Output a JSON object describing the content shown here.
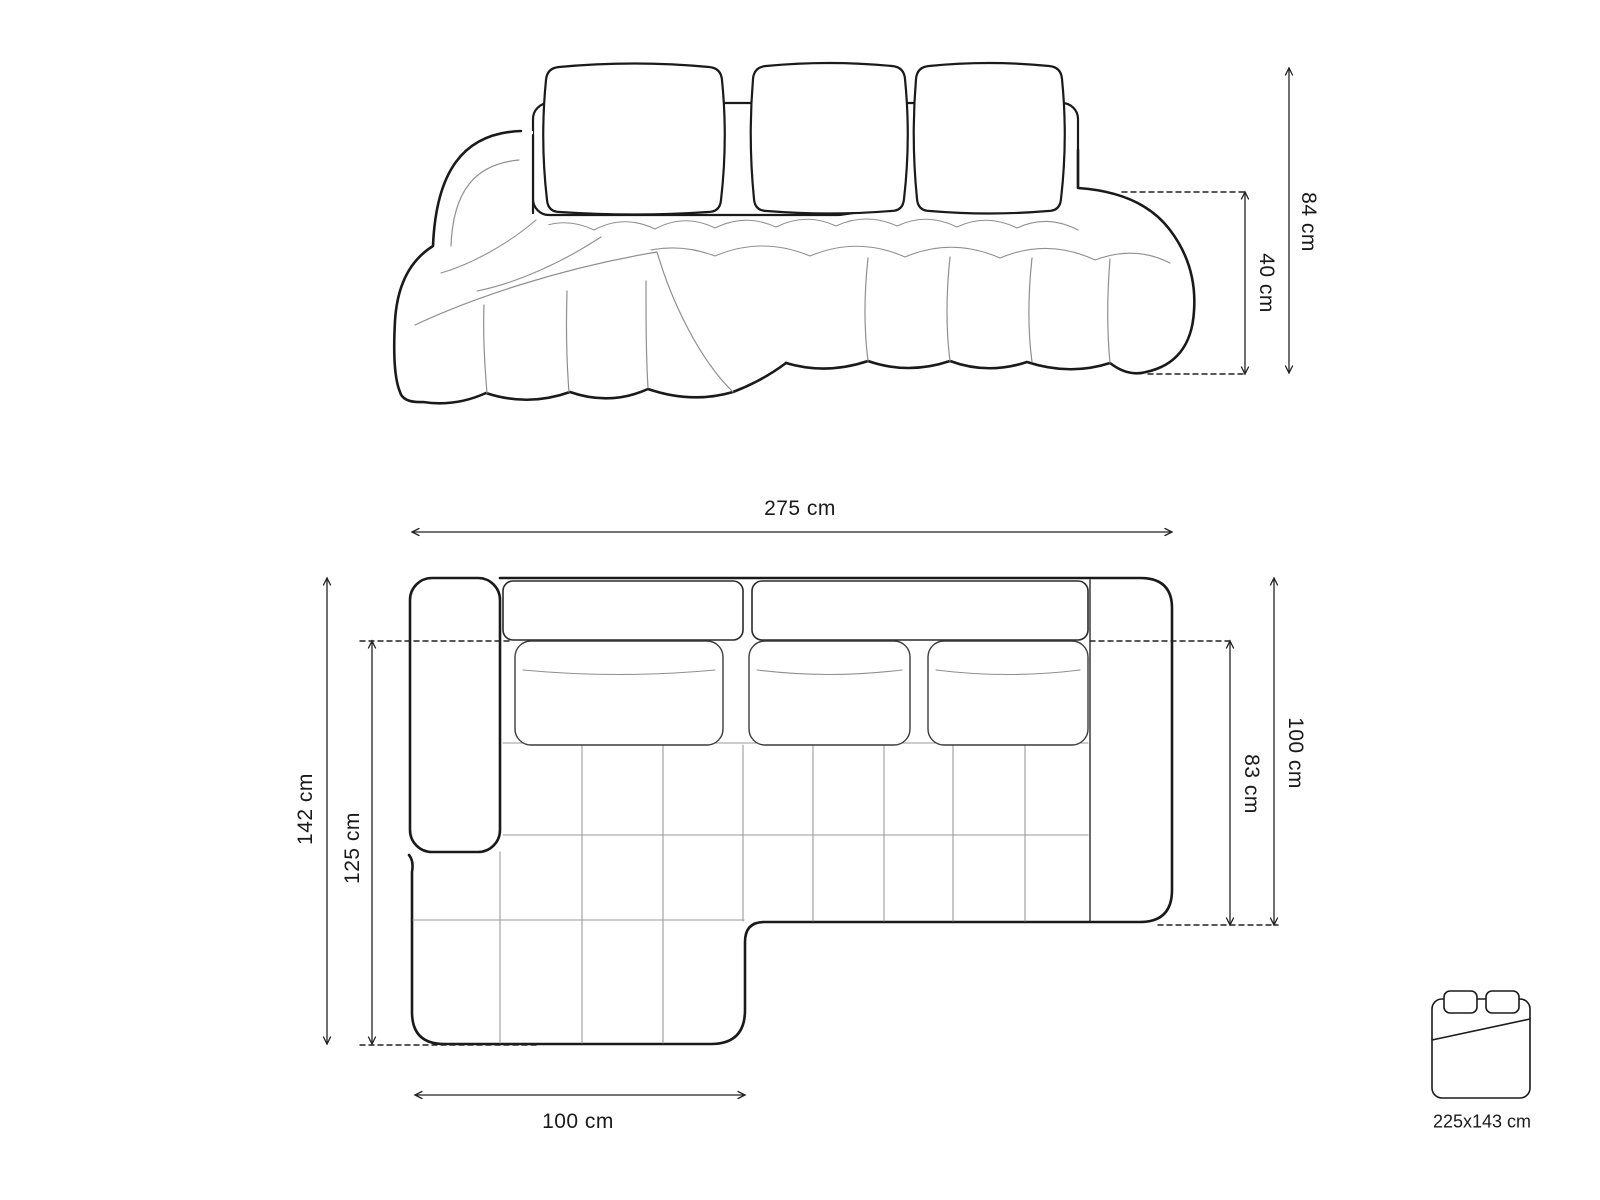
{
  "page": {
    "background": "#ffffff"
  },
  "front_view": {
    "name": "sofa front elevation",
    "dimensions": {
      "total_height": "84 cm",
      "seat_height": "40 cm"
    }
  },
  "top_view": {
    "name": "sofa top plan",
    "dimensions": {
      "total_width": "275 cm",
      "total_depth": "142 cm",
      "chaise_length": "125 cm",
      "right_side_depth": "100 cm",
      "right_seat_depth": "83 cm",
      "chaise_width": "100 cm"
    }
  },
  "sleeping_area": {
    "size": "225x143 cm"
  },
  "colors": {
    "outline": "#1a1a1a",
    "seam": "#8f8f8f",
    "grid": "#9a9a9a",
    "dimension": "#222222"
  }
}
